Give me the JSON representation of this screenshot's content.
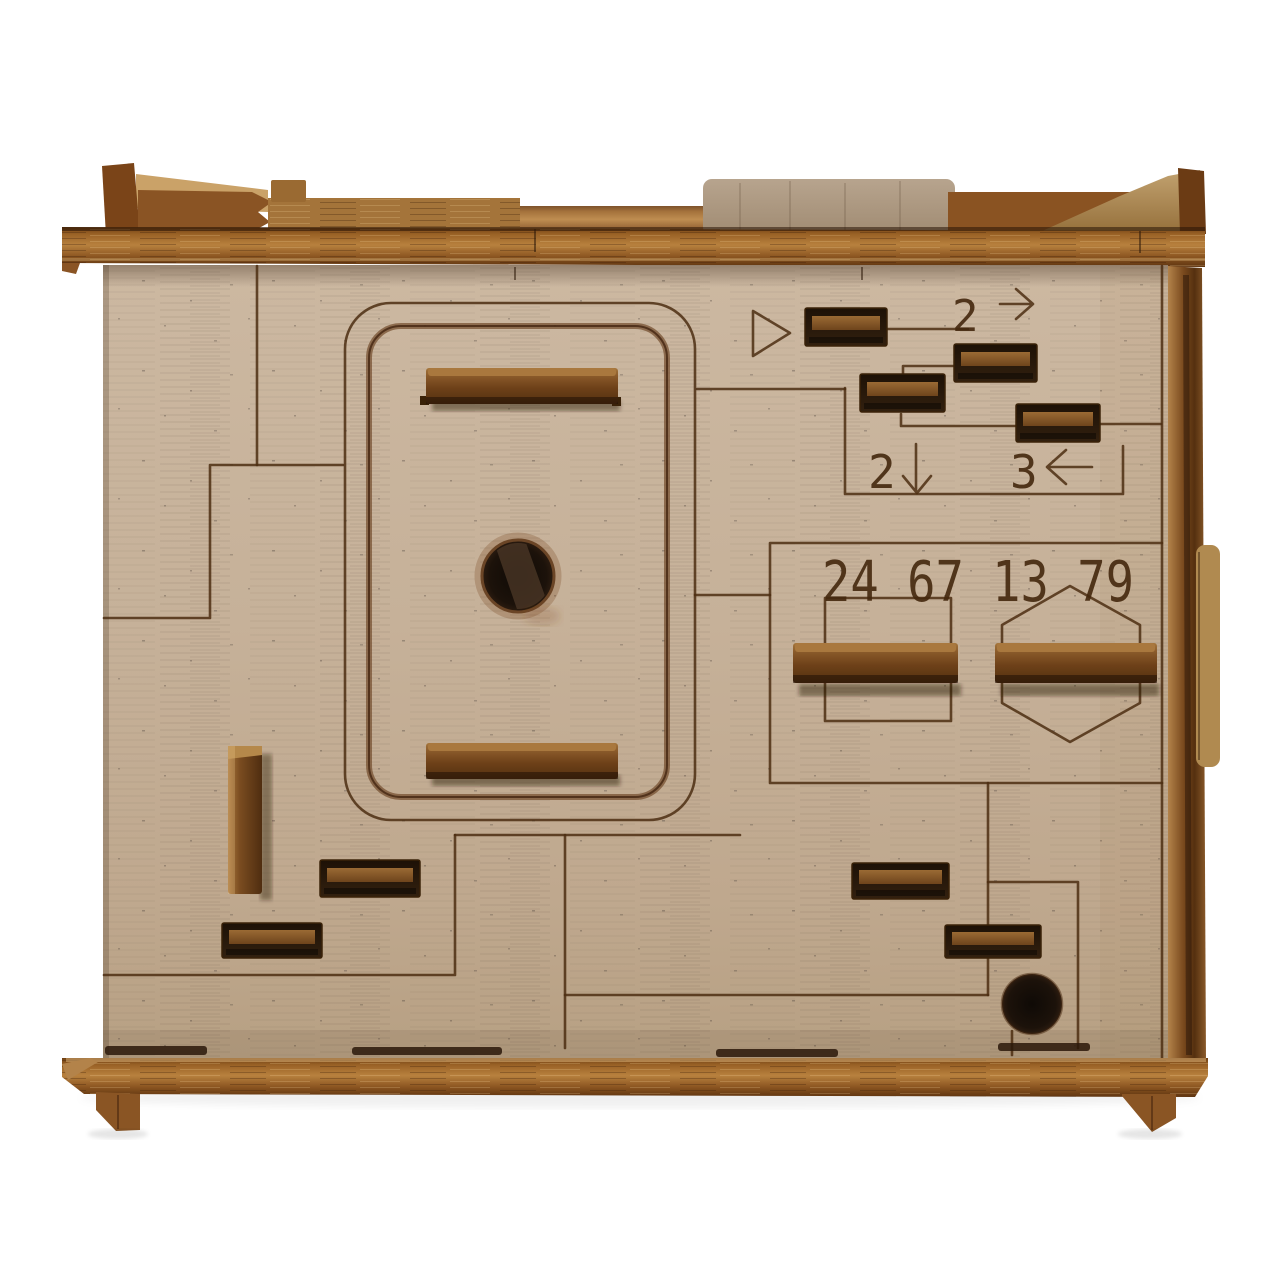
{
  "scene": {
    "type": "product-photo",
    "subject": "laser-cut wooden puzzle box (escape-room style), front view",
    "background": "#ffffff"
  },
  "colors": {
    "face_wood": "#c6b199",
    "rail_wood": "#9a6226",
    "slat_wood": "#6e4119",
    "light_tab_wood": "#b09d87",
    "engraving": "#4c2e12",
    "slot_interior": "#241507",
    "hole": "#17100a"
  },
  "engravings": {
    "code": "24 67 13 79",
    "hints": [
      {
        "digit": "2",
        "arrow": "right"
      },
      {
        "digit": "2",
        "arrow": "down"
      },
      {
        "digit": "3",
        "arrow": "left"
      }
    ],
    "shapes": [
      "triangle",
      "square",
      "hexagon",
      "rounded-panel-outline",
      "maze-lines"
    ]
  },
  "parts": {
    "sliders": [
      {
        "name": "panel-slider-top"
      },
      {
        "name": "panel-slider-bottom"
      },
      {
        "name": "square-slider"
      },
      {
        "name": "hexagon-slider"
      },
      {
        "name": "vertical-slider"
      }
    ],
    "recessed_slots": 8,
    "holes": 2,
    "top_tab": 1,
    "side_tab": 1,
    "feet": 2
  }
}
